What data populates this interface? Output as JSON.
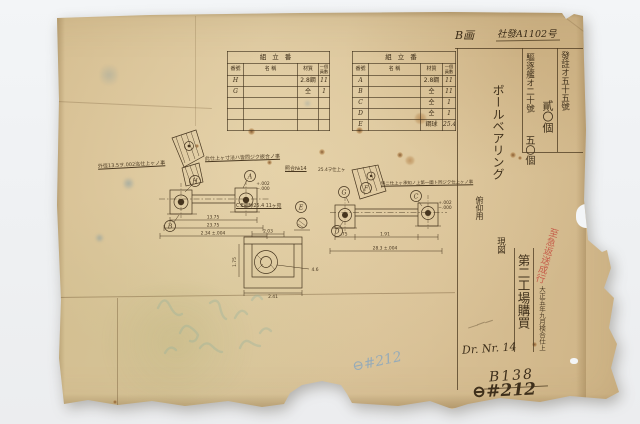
{
  "header": {
    "mark": "B画",
    "doc_no": "社發A1102号"
  },
  "orders": {
    "col1": "發註オ五十五號",
    "col1_qty": "貳〇個",
    "col2": "驅逐艦オ二十號",
    "col2_qty": "五〇個"
  },
  "title_block": {
    "title": "ボールベアリング",
    "usage": "俯仰用",
    "genzu": "現図",
    "buyer": "第二工場購買",
    "date_note": "大正五年九月検合仕上",
    "red_note": "至急返送成行"
  },
  "tables": {
    "header": "組立番",
    "columns": {
      "no": "番號",
      "name": "名 稱",
      "material": "材質",
      "qty1": "一個",
      "qty2": "員數"
    },
    "left_rows": [
      {
        "no": "H",
        "name": "",
        "mat": "2.8鋼",
        "qty": "11"
      },
      {
        "no": "G",
        "name": "",
        "mat": "仝",
        "qty": "1"
      },
      {
        "no": "",
        "name": "",
        "mat": "",
        "qty": ""
      },
      {
        "no": "",
        "name": "",
        "mat": "",
        "qty": ""
      },
      {
        "no": "",
        "name": "",
        "mat": "",
        "qty": ""
      }
    ],
    "right_rows": [
      {
        "no": "A",
        "name": "",
        "mat": "2.8鋼",
        "qty": "11"
      },
      {
        "no": "B",
        "name": "",
        "mat": "仝",
        "qty": "11"
      },
      {
        "no": "C",
        "name": "",
        "mat": "仝",
        "qty": "1"
      },
      {
        "no": "D",
        "name": "",
        "mat": "仝",
        "qty": "1"
      },
      {
        "no": "E",
        "name": "",
        "mat": "鋼球",
        "qty": "25.4"
      }
    ]
  },
  "drawing": {
    "ann_left": "外徑13.5ヲ.002迄仕上ヶノ事",
    "ann_center": "此仕上ヶ寸法ハ皆同ジク嵌合ノ事",
    "ann_right": "特ニ仕上ヶ承知ノ上第一圖ト同ジク仕上ヶノ事",
    "ann_bracket": "25.4ヲ仕上ヶ",
    "ref_no": "照合№14",
    "ball_note": "C.E鋼球25.4 11ヶ宛",
    "labels": {
      "a": "A",
      "b": "B",
      "c": "C",
      "d": "D",
      "e": "E",
      "f": "F",
      "g": "G",
      "h": "H"
    },
    "dims_left": [
      "13.75",
      "23.75",
      "2.34 ±.004"
    ],
    "dims_right": [
      ".75",
      "1.91",
      "28.3 ±.004"
    ],
    "dims_detail": {
      "top": "2.03",
      "left": "1.75",
      "right": "4.6",
      "bottom": "2.41"
    },
    "tol_plus": "+.002",
    "tol_minus": "−.000"
  },
  "footer": {
    "dr_nr": "Dr. Nr. 14",
    "b_no": "B138",
    "circle_no": "⊖#212",
    "blue_no": "⊖#212"
  }
}
